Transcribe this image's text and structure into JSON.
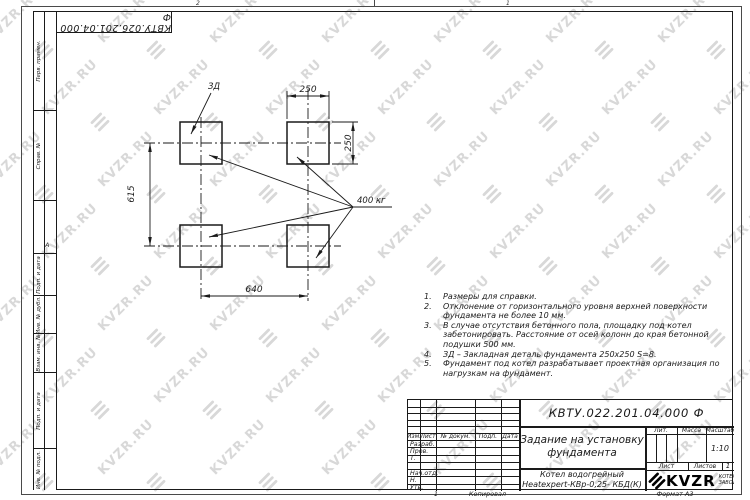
{
  "watermark": {
    "text": "KVZR.RU"
  },
  "sheet": {
    "top_stamp": "КВТУ.026.201.04.000 Ф",
    "zone_top_1": "2",
    "zone_top_2": "1",
    "zone_side": "А",
    "margin_labels": {
      "perv": "Перв. примен.",
      "sprav": "Справ. №",
      "podp1": "Подп. и дата",
      "inv_dubl": "Инв. № дубл.",
      "vzam": "Взам. инв. №",
      "podp2": "Подп. и дата",
      "inv_podl": "Инв. № подл."
    },
    "footer": {
      "num": "1",
      "copied": "Копировал",
      "format": "Формат А3"
    }
  },
  "drawing": {
    "part_label": "ЗД",
    "load_label": "400 кг",
    "dim_top": "250",
    "dim_right": "250",
    "dim_left": "615",
    "dim_bottom": "640"
  },
  "notes": [
    {
      "num": "1.",
      "lines": [
        "Размеры для справки."
      ]
    },
    {
      "num": "2.",
      "lines": [
        "Отклонение от горизонтального уровня верхней поверхности",
        "фундамента не более 10 мм."
      ]
    },
    {
      "num": "3.",
      "lines": [
        "В случае отсутствия бетонного пола, площадку под котел",
        "забетонировать. Расстояние от осей колонн до края бетонной",
        "подушки 500 мм."
      ]
    },
    {
      "num": "4.",
      "lines": [
        "ЗД – Закладная деталь фундамента 250х250 S=8."
      ]
    },
    {
      "num": "5.",
      "lines": [
        "Фундамент под котел разрабатывает проектная организация по",
        "нагрузкам на фундамент."
      ]
    }
  ],
  "title_block": {
    "doc_number": "КВТУ.022.201.04.000 Ф",
    "title_line1": "Задание на установку",
    "title_line2": "фундамента",
    "product_line1": "Котел водогрейный",
    "product_line2": "Heatexpert-КВр-0,25- КБД(К)",
    "header_cols": [
      "Изм.",
      "Лист",
      "№ докум.",
      "Подп.",
      "Дата"
    ],
    "rows": [
      "Разраб.",
      "Пров.",
      "Т. контр.",
      "Нач.отд.",
      "Н. контр.",
      "Утв."
    ],
    "lit_label": "Лит.",
    "mass_label": "Масса",
    "scale_label": "Масштаб",
    "scale_value": "1:10",
    "sheet_label": "Лист",
    "sheets_label": "Листов",
    "sheets_value": "1",
    "logo_text": "KVZR",
    "logo_sub1": "КОТЕЛЬНЫЙ",
    "logo_sub2": "ЗАВОД РЭП"
  }
}
